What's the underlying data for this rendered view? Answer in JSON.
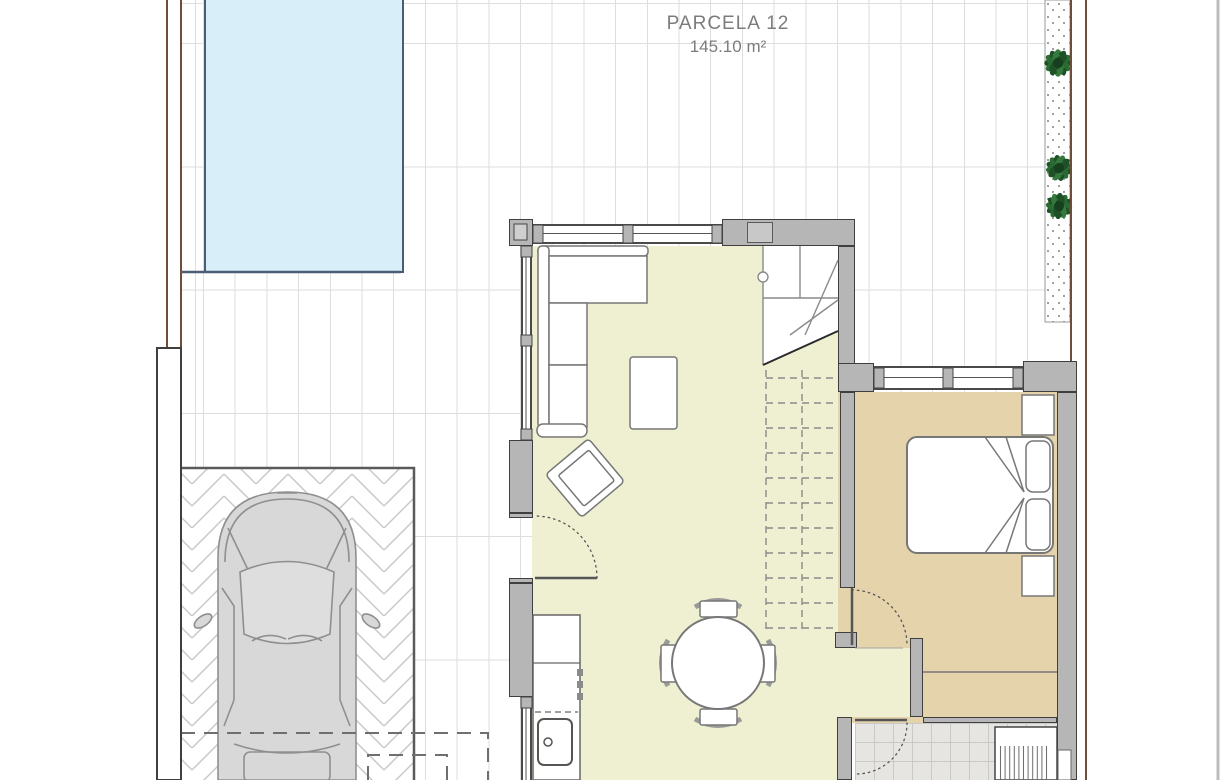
{
  "page": {
    "type": "architectural-floor-plan",
    "view": "top-down plan of parcel with house, terrace, pool and parking"
  },
  "labels": {
    "parcel_title": "PARCELA 12",
    "parcel_area": "145.10 m²"
  },
  "colors": {
    "pool_fill": "#d8eef8",
    "pool_border": "#4a5d73",
    "living_floor": "#eef0d1",
    "bedroom_floor": "#e4d3ab",
    "bathroom_tile": "#e6e5e1",
    "wall_gray": "#b6b6b6",
    "boundary_brown": "#6e4e38",
    "plant_green": "#2a6b33",
    "terrace_tile_line": "#dedede",
    "car_body": "#d8d8d8"
  },
  "outdoor": {
    "pool": "swimming pool",
    "planter": "gravel planter strip with 3 round bushes",
    "driveway": "herringbone paved parking with car (top view)",
    "porch_outline": "dashed roof-overhang outline",
    "boundaries": "brown parcel boundary lines left and right"
  },
  "rooms": [
    {
      "name": "living-dining room",
      "floor": "pale yellow",
      "furniture": [
        "corner sofa",
        "coffee table",
        "armchair",
        "round dining table",
        "4 dining chairs"
      ]
    },
    {
      "name": "kitchen",
      "fixtures": [
        "counter run",
        "drawer unit",
        "dishwasher (dashed)",
        "sink with tap"
      ]
    },
    {
      "name": "stairwell",
      "detail": "winder stair, upper flight dashed"
    },
    {
      "name": "bedroom",
      "furniture": [
        "double bed with folded blanket",
        "2 nightstands",
        "wardrobe"
      ]
    },
    {
      "name": "bathroom",
      "fixtures": [
        "shower with striped tray",
        "tiled floor"
      ]
    }
  ],
  "door_count": 3,
  "window_count": 4
}
